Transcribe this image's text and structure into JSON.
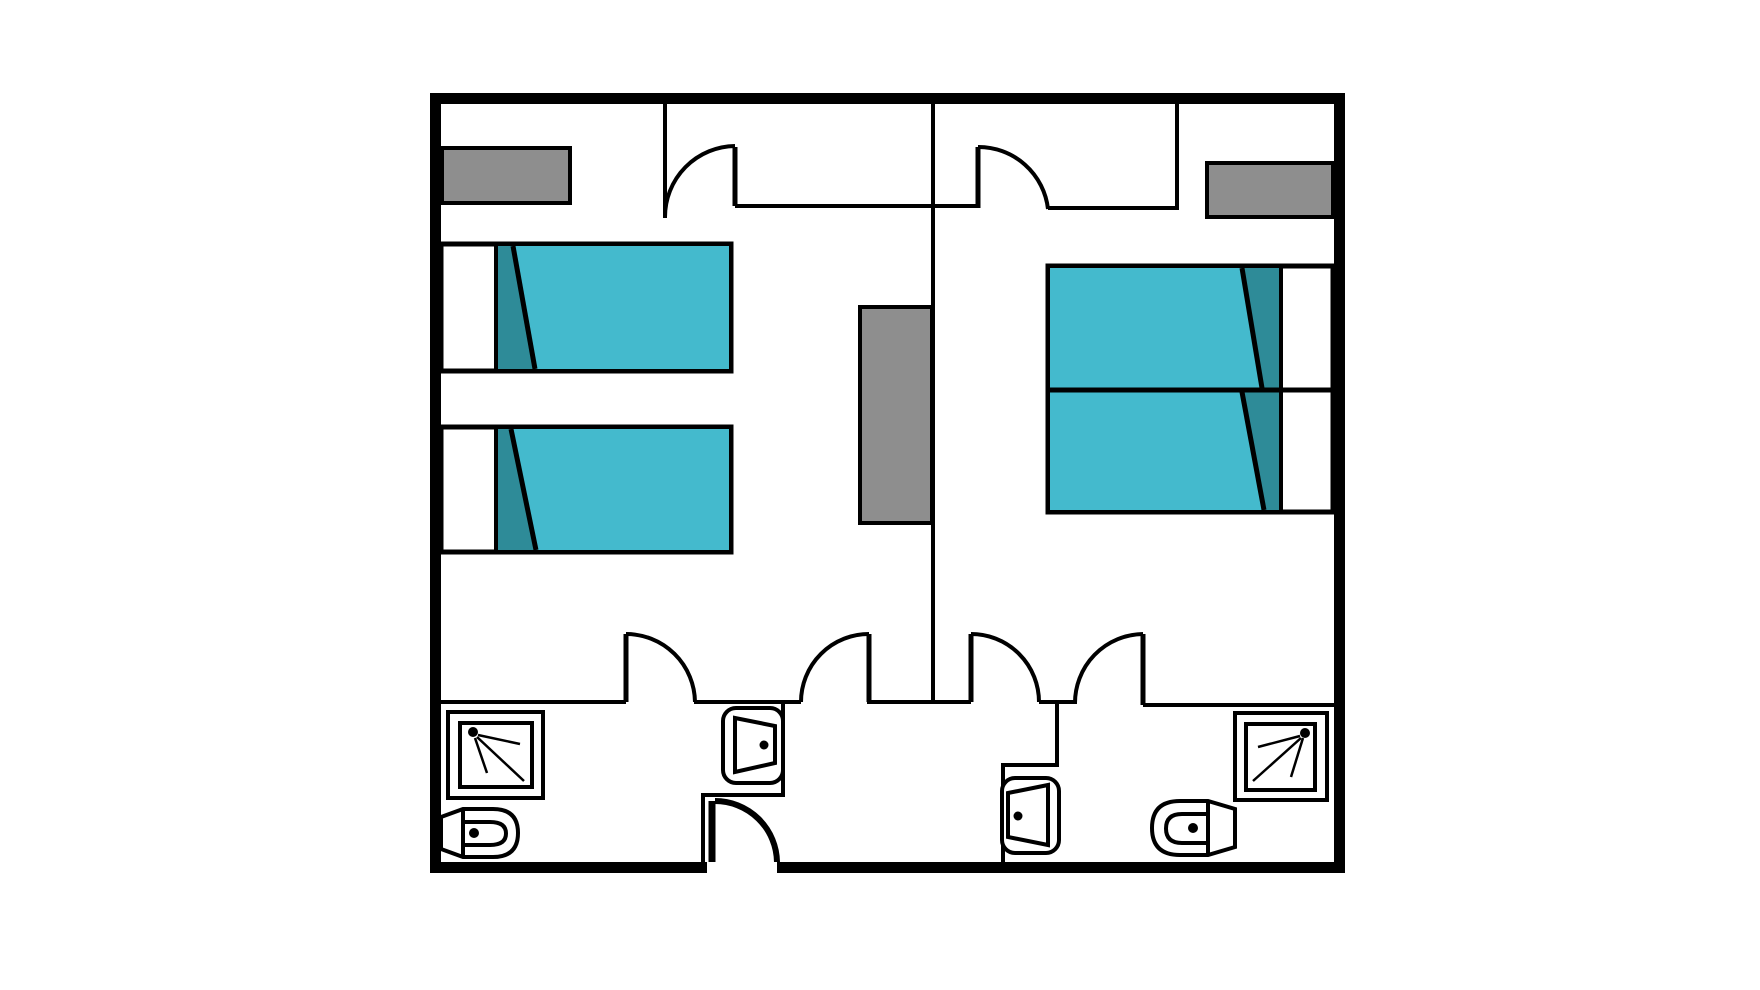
{
  "canvas": {
    "width": 1760,
    "height": 990,
    "background": "#FFFFFF"
  },
  "colors": {
    "walls": "#000000",
    "lines": "#000000",
    "mattress_teal": "#44BACD",
    "pillow_teal": "#2E8B98",
    "furniture_gray": "#8E8E8E",
    "fixture_white": "#FFFFFF"
  },
  "floor_plan": {
    "description": "Floor plan of two mirrored hotel-style rooms with bathrooms below and a shared entrance",
    "rooms": [
      {
        "id": "left-room",
        "beds": 2,
        "bed_layout": "two single beds, pillows toward left wall",
        "furniture": [
          "dresser"
        ],
        "bathroom_fixtures": [
          "shower",
          "toilet",
          "sink"
        ],
        "door_symbols": 3
      },
      {
        "id": "right-room",
        "beds": 2,
        "bed_layout": "two beds pushed together, pillows toward right wall",
        "furniture": [
          "dresser"
        ],
        "bathroom_fixtures": [
          "shower",
          "toilet",
          "sink"
        ],
        "door_symbols": 3
      }
    ],
    "shared_elements": {
      "center_cabinet": 1,
      "entrance_door_symbols": 1
    },
    "totals": {
      "beds": 4,
      "showers": 2,
      "toilets": 2,
      "sinks": 2,
      "door_symbols": 7,
      "gray_furniture_pieces": 3
    }
  }
}
